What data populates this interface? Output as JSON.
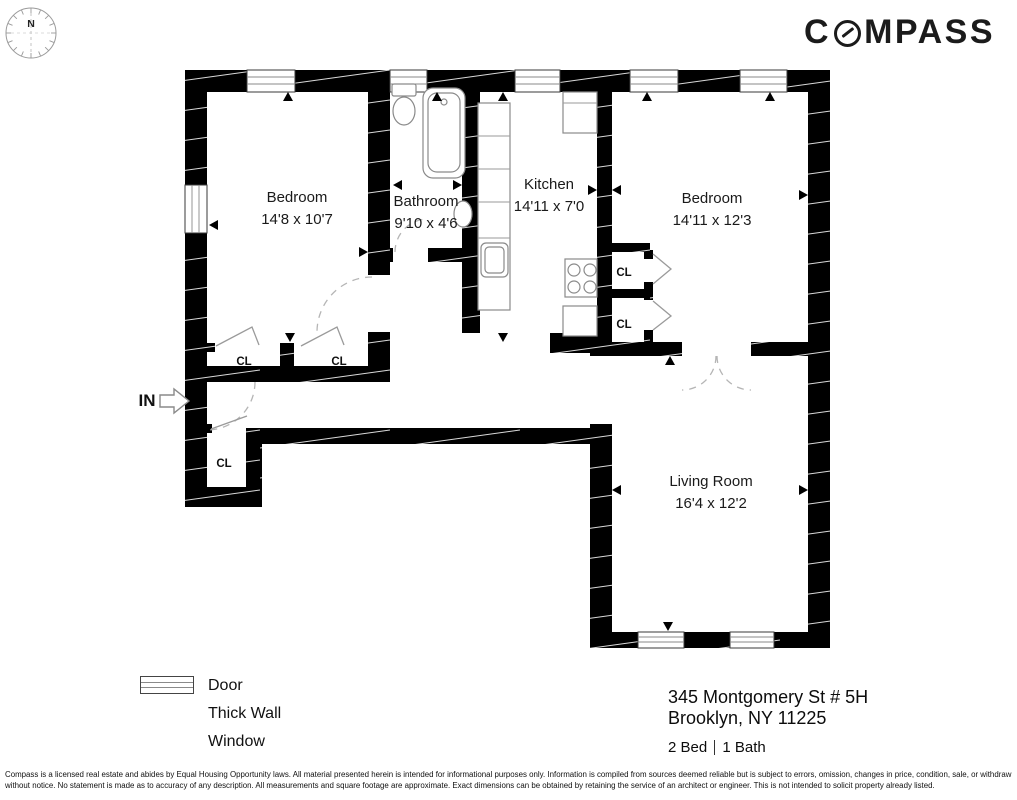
{
  "header": {
    "logo_prefix": "C",
    "logo_suffix": "MPASS",
    "compass_rose_label": "N"
  },
  "floorplan": {
    "entry_label": "IN",
    "closet_label": "CL",
    "rooms": [
      {
        "name": "Bedroom",
        "dims": "14'8 x 10'7"
      },
      {
        "name": "Bathroom",
        "dims": "9'10 x 4'6"
      },
      {
        "name": "Kitchen",
        "dims": "14'11 x 7'0"
      },
      {
        "name": "Bedroom",
        "dims": "14'11 x 12'3"
      },
      {
        "name": "Living Room",
        "dims": "16'4 x 12'2"
      }
    ]
  },
  "legend": {
    "items": [
      {
        "label": "Door",
        "symbol": "thin-line"
      },
      {
        "label": "Thick Wall",
        "symbol": "filled-black-bar"
      },
      {
        "label": "Window",
        "symbol": "outlined-bar"
      }
    ]
  },
  "property": {
    "address_line1": "345 Montgomery St # 5H",
    "address_line2": "Brooklyn, NY 11225",
    "beds": "2 Bed",
    "baths": "1 Bath"
  },
  "disclaimer": "Compass is a licensed real estate and abides by Equal Housing Opportunity laws. All material presented herein is intended for informational purposes only. Information is compiled from sources deemed reliable but is subject to errors, omission, changes in price, condition, sale, or withdraw without notice. No statement is made as to accuracy of any description. All measurements and square footage are approximate. Exact dimensions can be obtained by retaining the service of an architect or engineer. This is not intended to solicit property already listed.",
  "colors": {
    "wall": "#000000",
    "background": "#ffffff",
    "text": "#1a1a1a",
    "door_arc": "#b5b5b5",
    "fixture_stroke": "#8a8a8a"
  }
}
